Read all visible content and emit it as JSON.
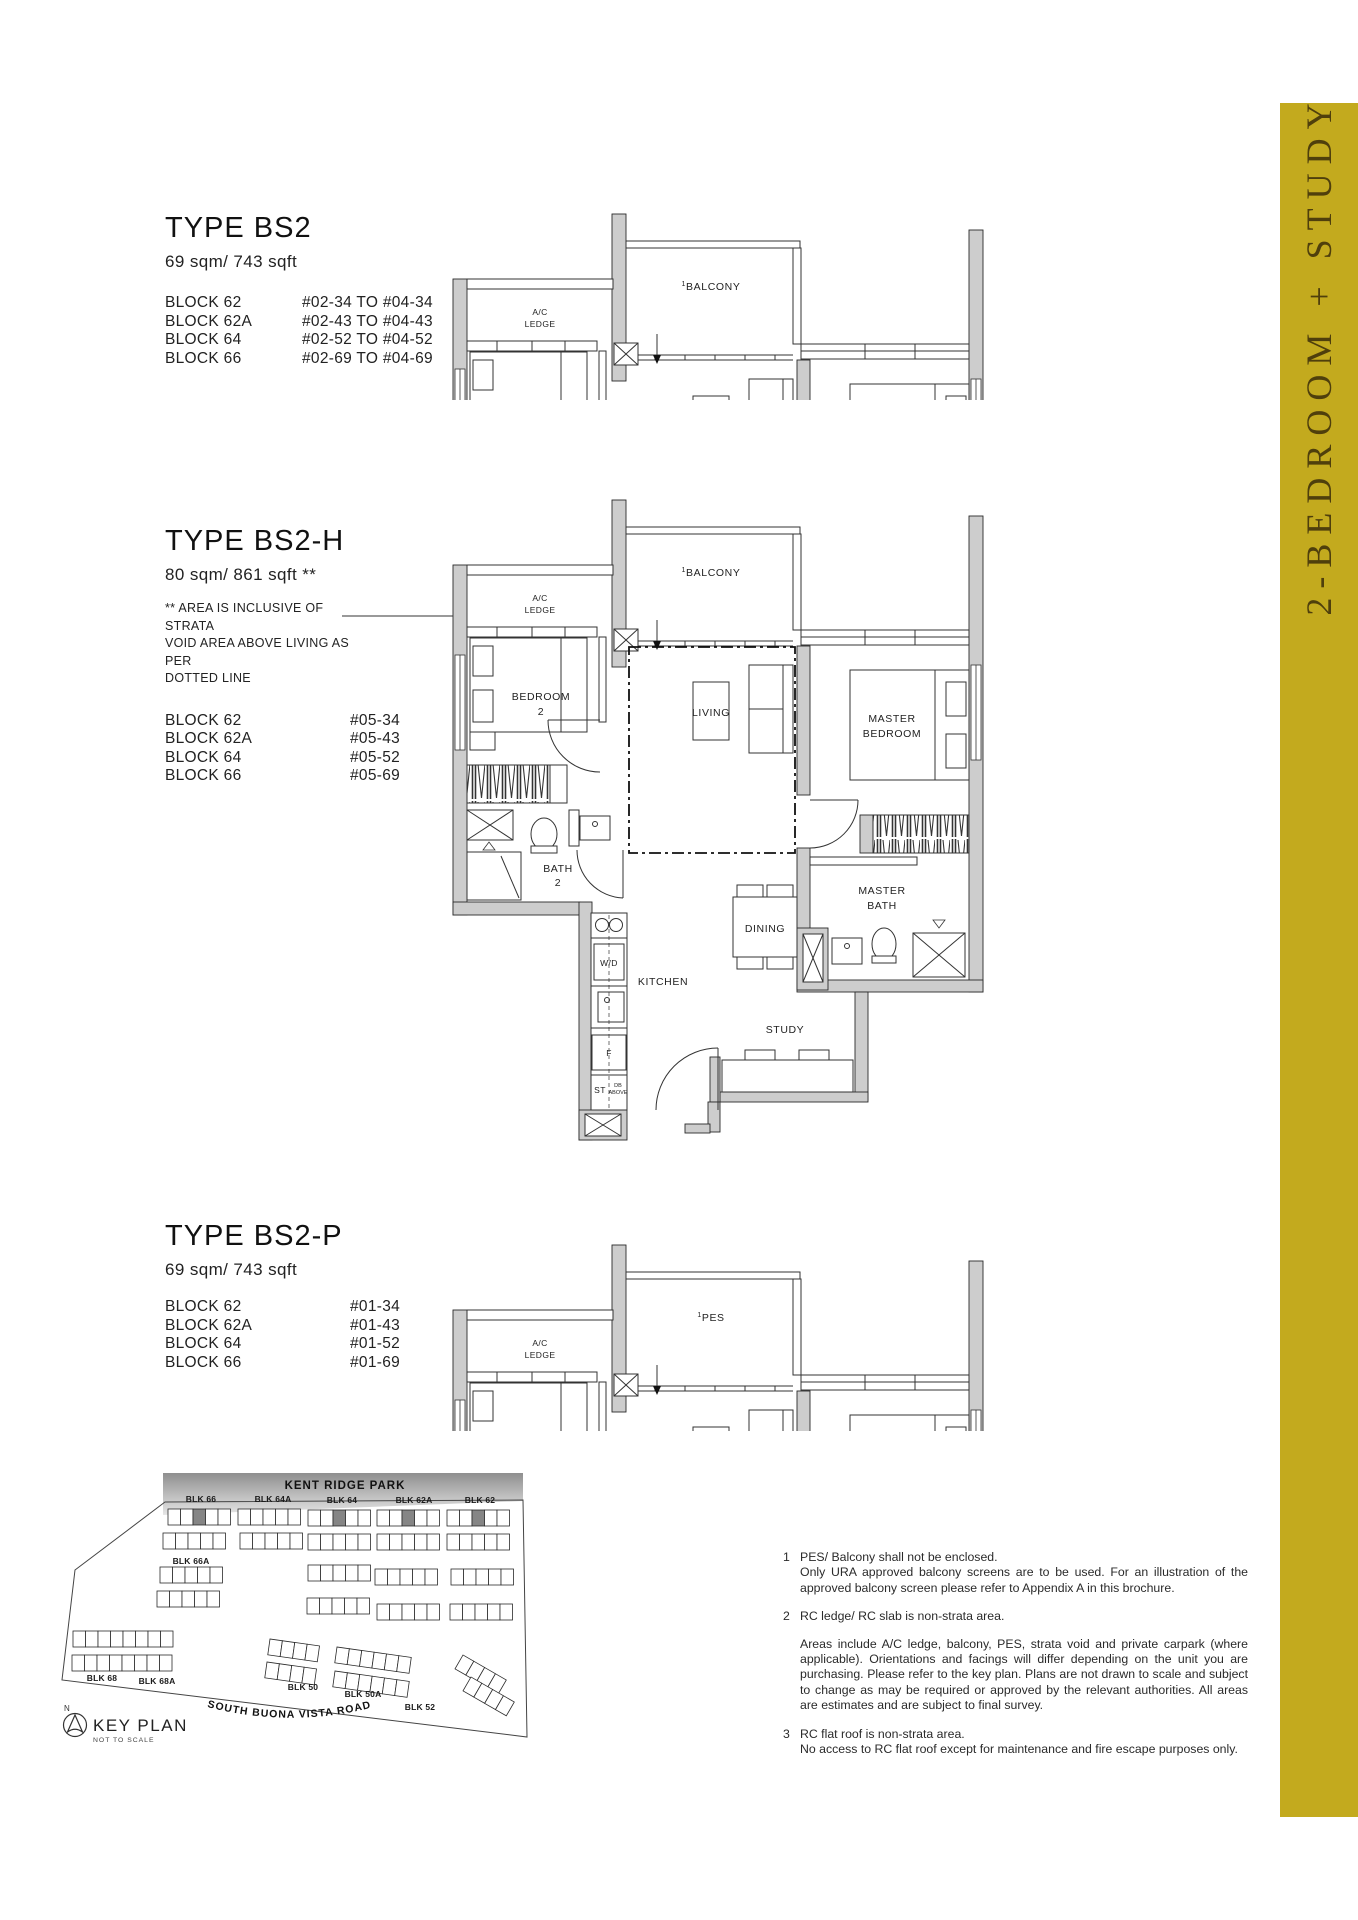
{
  "sidebar": {
    "label": "2-BEDROOM + STUDY",
    "bg": "#C3AA1E",
    "fg": "#4F3F0C"
  },
  "types": [
    {
      "title": "TYPE BS2",
      "area": "69 sqm/ 743 sqft",
      "blocks": [
        [
          "BLOCK 62",
          "#02-34 TO #04-34"
        ],
        [
          "BLOCK 62A",
          "#02-43 TO #04-43"
        ],
        [
          "BLOCK 64",
          "#02-52 TO #04-52"
        ],
        [
          "BLOCK 66",
          "#02-69 TO #04-69"
        ]
      ]
    },
    {
      "title": "TYPE BS2-H",
      "area": "80 sqm/ 861 sqft **",
      "note_lines": [
        "** AREA IS INCLUSIVE OF STRATA",
        "VOID AREA ABOVE LIVING AS PER",
        "DOTTED LINE"
      ],
      "blocks": [
        [
          "BLOCK 62",
          "#05-34"
        ],
        [
          "BLOCK 62A",
          "#05-43"
        ],
        [
          "BLOCK 64",
          "#05-52"
        ],
        [
          "BLOCK 66",
          "#05-69"
        ]
      ]
    },
    {
      "title": "TYPE BS2-P",
      "area": "69 sqm/ 743 sqft",
      "blocks": [
        [
          "BLOCK 62",
          "#01-34"
        ],
        [
          "BLOCK 62A",
          "#01-43"
        ],
        [
          "BLOCK 64",
          "#01-52"
        ],
        [
          "BLOCK 66",
          "#01-69"
        ]
      ]
    }
  ],
  "plan_labels": {
    "sup": "1",
    "balcony": "BALCONY",
    "pes": "PES",
    "ac_1": "A/C",
    "ac_2": "LEDGE",
    "bedroom2_1": "BEDROOM",
    "bedroom2_2": "2",
    "living": "LIVING",
    "master_1": "MASTER",
    "master_2": "BEDROOM",
    "bath2_1": "BATH",
    "bath2_2": "2",
    "mbath_1": "MASTER",
    "mbath_2": "BATH",
    "dining": "DINING",
    "kitchen": "KITCHEN",
    "study": "STUDY",
    "wd": "W/D",
    "f": "F",
    "st": "ST",
    "db_1": "DB",
    "db_2": "ABOVE"
  },
  "keyplan": {
    "park": "KENT RIDGE PARK",
    "road": "SOUTH BUONA VISTA ROAD",
    "title": "KEY PLAN",
    "subtitle": "NOT TO SCALE",
    "north": "N",
    "block_labels": [
      "BLK 66",
      "BLK 64A",
      "BLK 64",
      "BLK 62A",
      "BLK 62",
      "BLK 66A",
      "BLK 68",
      "BLK 68A",
      "BLK 50",
      "BLK 50A",
      "BLK 52"
    ]
  },
  "footnotes": [
    {
      "num": "1",
      "line1": "PES/ Balcony shall not be enclosed.",
      "para": "Only URA approved balcony screens are to be used. For an illustration of the approved balcony screen please refer to Appendix A in this brochure."
    },
    {
      "num": "2",
      "line1": "RC ledge/ RC slab is non-strata area.",
      "para": "Areas include A/C ledge, balcony, PES, strata void and private carpark (where applicable). Orientations and facings will differ depending on the unit you are purchasing. Please refer to the key plan. Plans are not drawn to scale and subject to change as may be required or approved by the relevant authorities. All areas are estimates and are subject to final survey."
    },
    {
      "num": "3",
      "line1": "RC flat roof is non-strata area.",
      "para": "No access to RC flat roof except for maintenance and fire escape purposes only."
    }
  ]
}
